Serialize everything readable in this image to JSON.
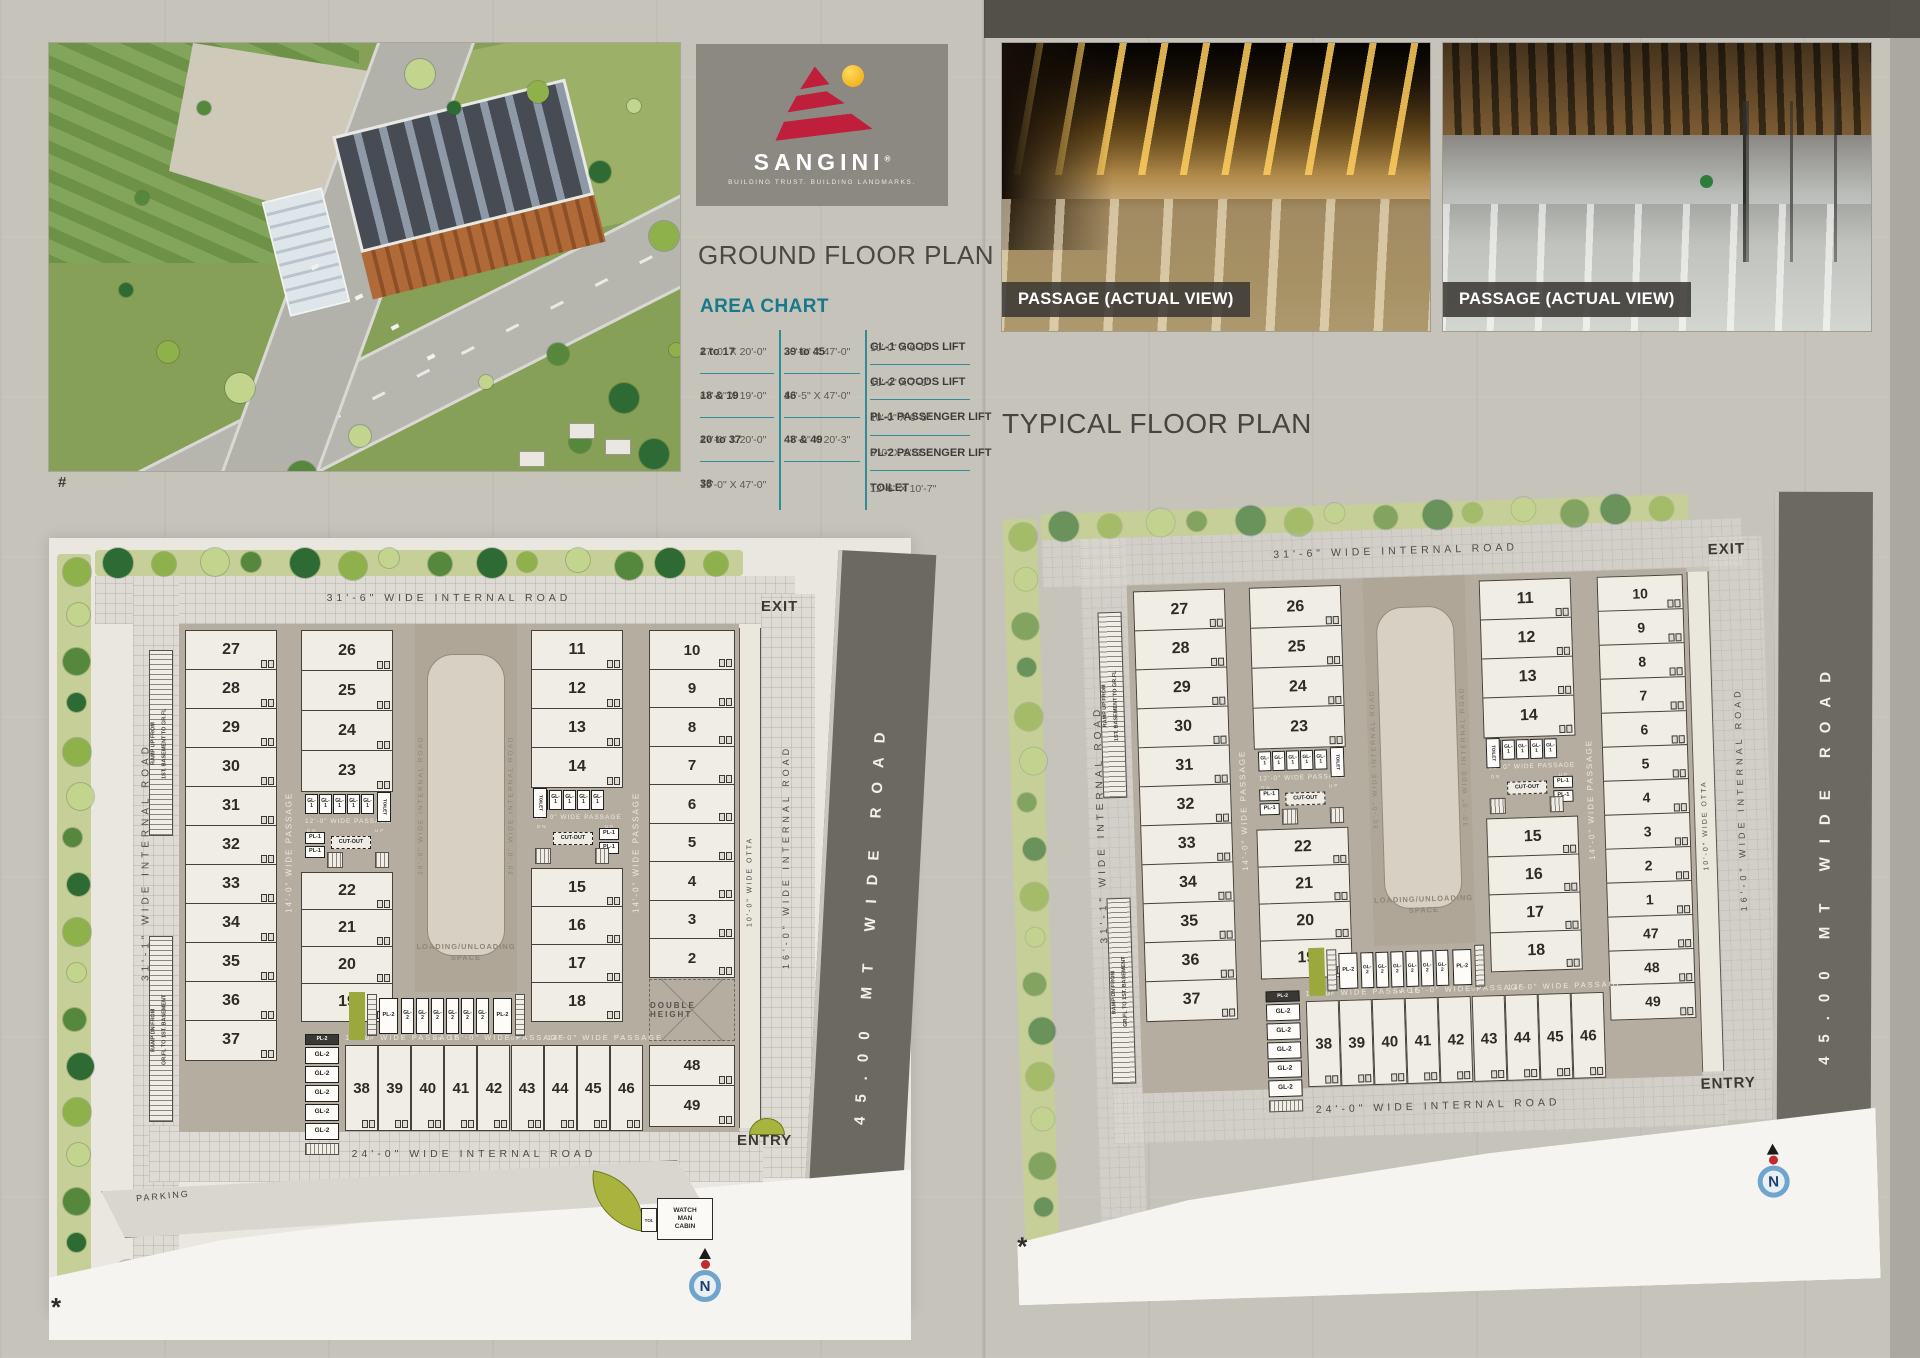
{
  "logo": {
    "name": "SANGINI",
    "mark": "®",
    "tagline": "BUILDING TRUST. BUILDING LANDMARKS."
  },
  "sections": {
    "ground_heading": "GROUND FLOOR PLAN",
    "typical_heading": "TYPICAL FLOOR PLAN"
  },
  "area_chart": {
    "title": "AREA CHART",
    "col1": [
      {
        "label": "2 to 17",
        "dim": "47'-0\" X 20'-0\""
      },
      {
        "label": "18 & 19",
        "dim": "47'-0\" X 19'-0\""
      },
      {
        "label": "20 to 37",
        "dim": "47'-0\" X 20'-0\""
      },
      {
        "label": "38",
        "dim": "19'-0\" X 47'-0\""
      }
    ],
    "col2": [
      {
        "label": "39 to 45",
        "dim": "20'-0\" X 47'-0\""
      },
      {
        "label": "46",
        "dim": "18'-5\" X 47'-0\""
      },
      {
        "label": "48 & 49",
        "dim": "47'-0\" X 20'-3\""
      }
    ],
    "col3": [
      {
        "label": "GL-1 GOODS LIFT",
        "dim": "10'-0\" X 6'-0\""
      },
      {
        "label": "GL-2 GOODS LIFT",
        "dim": "10'-0\" X 7'-0\""
      },
      {
        "label": "PL-1 PASSENGER LIFT",
        "dim": "10'-0\" X 6'-0\""
      },
      {
        "label": "PL-2 PASSENGER LIFT",
        "dim": "6'-0\" X 8'-9\""
      },
      {
        "label": "TOILET",
        "dim": "12'-6\" X 10'-7\""
      }
    ]
  },
  "photos": [
    {
      "caption": "PASSAGE (ACTUAL VIEW)"
    },
    {
      "caption": "PASSAGE (ACTUAL VIEW)"
    }
  ],
  "plan_labels": {
    "road_top": "31'-6\" WIDE INTERNAL ROAD",
    "road_left": "31'-1\" WIDE INTERNAL ROAD",
    "road_bottom": "24'-0\" WIDE INTERNAL ROAD",
    "road_16": "16'-0\" WIDE INTERNAL ROAD",
    "road_30": "30'-0\" WIDE INTERNAL ROAD",
    "road_45": "45.00 MT WIDE ROAD",
    "otta": "10'-0\" WIDE OTTA",
    "passage_14": "14'-0\" WIDE PASSAGE",
    "passage_15": "15'-0\" WIDE PASSAGE",
    "passage_12": "12'-0\" WIDE PASSAGE",
    "loading_line1": "LOADING/UNLOADING",
    "loading_line2": "SPACE",
    "exit": "EXIT",
    "entry": "ENTRY",
    "parking": "PARKING",
    "double_height": "DOUBLE HEIGHT",
    "watchman_lines": [
      "WATCH",
      "MAN",
      "CABIN"
    ],
    "toi": "TOI.",
    "gl1": "GL-1",
    "gl2": "GL-2",
    "pl1": "PL-1",
    "pl2": "PL-2",
    "cutout": "CUT-OUT",
    "toilet": "TOILET",
    "up": "UP",
    "dn": "DN",
    "ramp_up_line1": "RAMP UP FROM",
    "ramp_up_line2": "1ST. BASEMENT TO GR.FL",
    "ramp_dn_line1": "RAMP DN FROM",
    "ramp_dn_line2": "GR.FL TO 1ST. BASEMENT"
  },
  "ground_plan": {
    "units": {
      "colA": [
        "27",
        "28",
        "29",
        "30",
        "31",
        "32",
        "33",
        "34",
        "35",
        "36",
        "37"
      ],
      "colB_top": [
        "26",
        "25",
        "24",
        "23"
      ],
      "colB_bottom": [
        "22",
        "21",
        "20",
        "19"
      ],
      "colC_top": [
        "11",
        "12",
        "13",
        "14"
      ],
      "colC_bottom": [
        "15",
        "16",
        "17",
        "18"
      ],
      "colD": [
        "10",
        "9",
        "8",
        "7",
        "6",
        "5",
        "4",
        "3",
        "2"
      ],
      "colD_extra": [
        "48",
        "49"
      ],
      "bottom": [
        "38",
        "39",
        "40",
        "41",
        "42",
        "43",
        "44",
        "45",
        "46"
      ]
    }
  },
  "typical_plan": {
    "units": {
      "colA": [
        "27",
        "28",
        "29",
        "30",
        "31",
        "32",
        "33",
        "34",
        "35",
        "36",
        "37"
      ],
      "colB_top": [
        "26",
        "25",
        "24",
        "23"
      ],
      "colB_bottom": [
        "22",
        "21",
        "20",
        "19"
      ],
      "colC_top": [
        "11",
        "12",
        "13",
        "14"
      ],
      "colC_bottom": [
        "15",
        "16",
        "17",
        "18"
      ],
      "colD": [
        "10",
        "9",
        "8",
        "7",
        "6",
        "5",
        "4",
        "3",
        "2",
        "1",
        "47",
        "48",
        "49"
      ],
      "colD_extra": [],
      "bottom": [
        "38",
        "39",
        "40",
        "41",
        "42",
        "43",
        "44",
        "45",
        "46"
      ]
    }
  },
  "symbols": {
    "north": "N",
    "star": "*",
    "hash": "#"
  }
}
